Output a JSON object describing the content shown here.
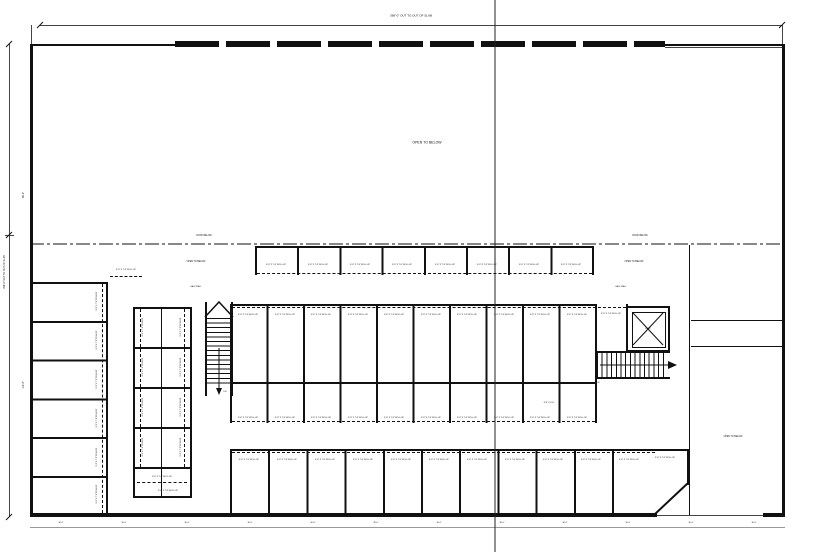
{
  "labels": {
    "open_to_below": "OPEN TO BELOW",
    "roof_below": "ROOF BELOW",
    "half_wall": "HALF WALL",
    "rollup": "8'-8\" X 7'-8\" ROLL-UP",
    "unit_small": "8'-8\" X 6'-8\"",
    "dn": "DN",
    "elev": "ELEV"
  },
  "dimensions": {
    "top_overall": "368'-0\" OUT TO OUT OF SLAB",
    "left_overall": "206'-0\" OUT TO OUT OF SLAB",
    "left_upper": "96'-0\"",
    "left_lower": "110'-0\"",
    "bottom": [
      "30'-0\"",
      "30'-0\"",
      "30'-0\"",
      "30'-0\"",
      "30'-0\"",
      "30'-0\"",
      "30'-0\"",
      "30'-0\"",
      "30'-0\"",
      "30'-0\"",
      "30'-0\"",
      "30'-0\""
    ]
  }
}
